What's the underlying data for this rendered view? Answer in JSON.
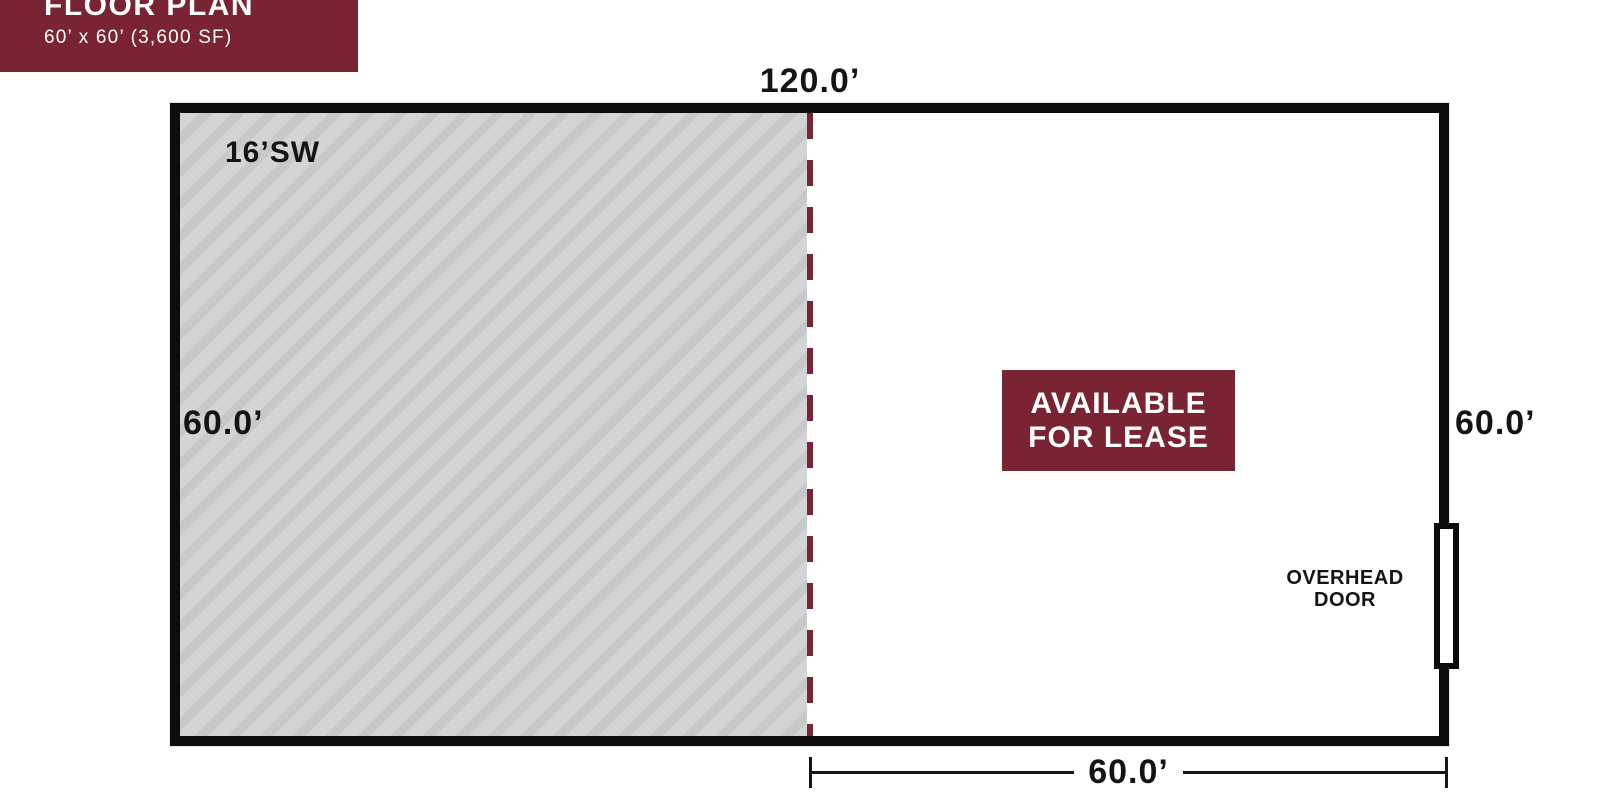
{
  "colors": {
    "accent": "#7A2433",
    "wall": "#0B0C0C",
    "hatch-light": "#D3D4D6",
    "hatch-dark": "#C7C8CA",
    "text": "#141414"
  },
  "title_block": {
    "title": "FLOOR PLAN",
    "subtitle": "60’ x 60’ (3,600 SF)"
  },
  "plan": {
    "dimensions": {
      "top": "120.0’",
      "left": "60.0’",
      "right": "60.0’",
      "bottom": "60.0’"
    },
    "hatched_area": {
      "label": "16’SW"
    },
    "badge": {
      "line1": "AVAILABLE",
      "line2": "FOR LEASE"
    },
    "overhead_door": {
      "line1": "OVERHEAD",
      "line2": "DOOR"
    }
  }
}
